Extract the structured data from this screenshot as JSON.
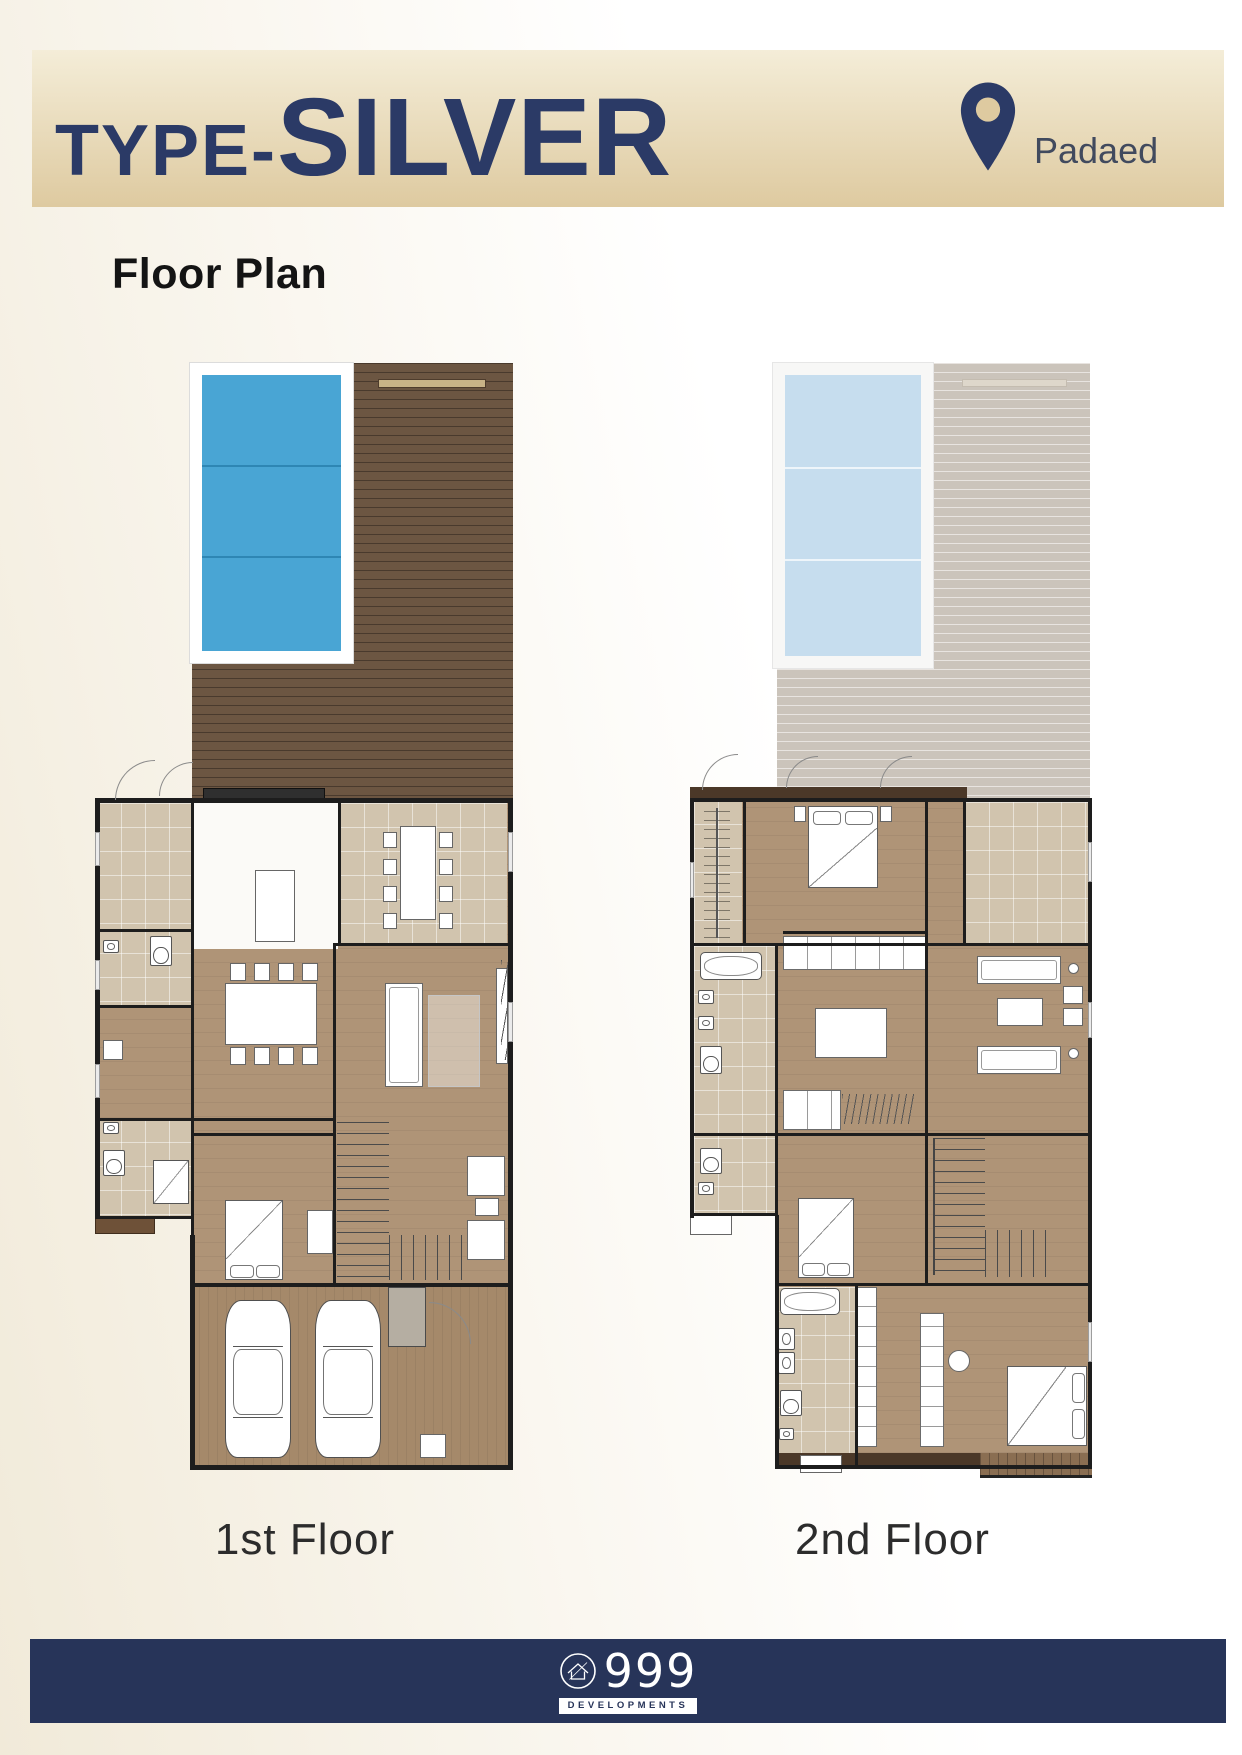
{
  "header": {
    "type_prefix": "TYPE-",
    "type_name": "SILVER",
    "location": "Padaed"
  },
  "section": {
    "heading": "Floor Plan"
  },
  "plans": [
    {
      "label": "1st Floor"
    },
    {
      "label": "2nd Floor"
    }
  ],
  "footer": {
    "brand_number": "999",
    "brand_sub": "DEVELOPMENTS"
  },
  "icons": {
    "location": "location-pin-icon",
    "logo": "house-circle-icon"
  },
  "colors": {
    "header_grad_top": "#f4edd8",
    "header_grad_bottom": "#decaa0",
    "navy": "#2b3a66",
    "location_text": "#414a5e",
    "heading_text": "#141414",
    "label_text": "#2c2c2c",
    "pool": "#49a5d4",
    "pool_lane": "#2e86b4",
    "pool_frame": "#ffffff",
    "deck": "#6c5642",
    "deck_bench": "#c8b387",
    "ghost_deck": "#cbc4bb",
    "ghost_pool": "#c6ddee",
    "ghost_frame": "#f7f7f6",
    "ghost_bench": "#ded7cb",
    "wood": "#af9477",
    "tile": "#d1c4ae",
    "kitchen": "#fbfaf7",
    "garage": "#a5896a",
    "wall": "#1d1d1d",
    "wall_brown": "#4b3828",
    "balcony_wood": "#8a6e52",
    "furn_fill": "#ffffff",
    "furn_line": "#666666",
    "footer_bg": "#273459",
    "page_cream": "#f1ead9"
  }
}
